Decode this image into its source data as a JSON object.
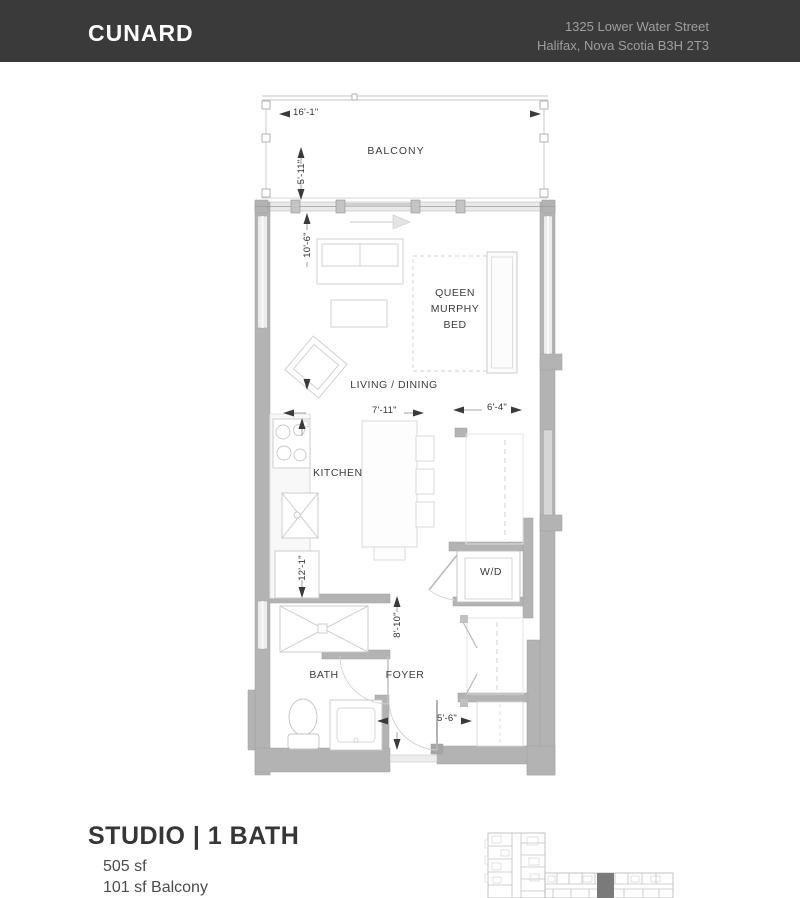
{
  "header": {
    "building_name": "CUNARD",
    "address_line1": "1325 Lower Water Street",
    "address_line2": "Halifax, Nova Scotia B3H 2T3"
  },
  "floor_plan": {
    "room_labels": {
      "balcony": "BALCONY",
      "living_dining": "LIVING / DINING",
      "murphy_bed": "QUEEN MURPHY BED",
      "kitchen": "KITCHEN",
      "washer_dryer": "W/D",
      "bath": "BATH",
      "foyer": "FOYER"
    },
    "dimensions": {
      "balcony_width": "16'-1\"",
      "balcony_depth": "5'-11\"",
      "living_length": "10'-6\"",
      "living_width": "7'-11\"",
      "closet_width": "6'-4\"",
      "kitchen_length": "12'-1\"",
      "foyer_length": "8'-10\"",
      "entry_width": "5'-6\""
    }
  },
  "unit_info": {
    "unit_type": "STUDIO | 1 BATH",
    "interior_area": "505 sf",
    "balcony_area": "101 sf Balcony"
  },
  "colors": {
    "header_background": "#3a3a3a",
    "header_text": "#ffffff",
    "address_text": "#9f9f9f",
    "wall_fill": "#b3b3b3",
    "label_text": "#3c3c3c",
    "keyplan_highlight": "#7a7a7a"
  }
}
